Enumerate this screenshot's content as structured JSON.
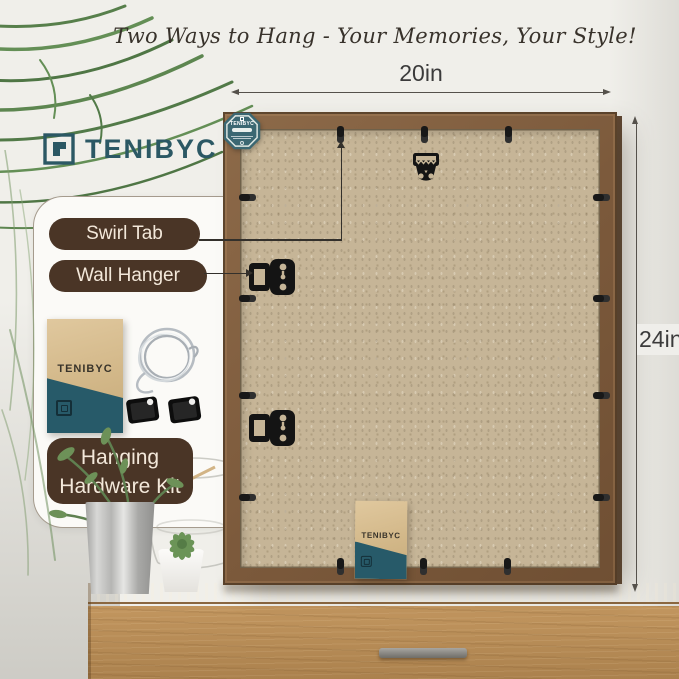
{
  "title": "Two Ways to Hang - Your Memories, Your Style!",
  "brand": {
    "name": "TENIBYC"
  },
  "dimensions": {
    "width": "20in",
    "height": "24in"
  },
  "callouts": {
    "swirl_tab": "Swirl Tab",
    "wall_hanger": "Wall Hanger",
    "hardware_kit_line1": "Hanging",
    "hardware_kit_line2": "Hardware Kit"
  },
  "colors": {
    "accent_teal": "#2E5A66",
    "label_brown": "#4A3526",
    "frame_wood": "#80603F",
    "backboard_tan": "#C5B496",
    "dresser_wood": "#B78A55"
  }
}
